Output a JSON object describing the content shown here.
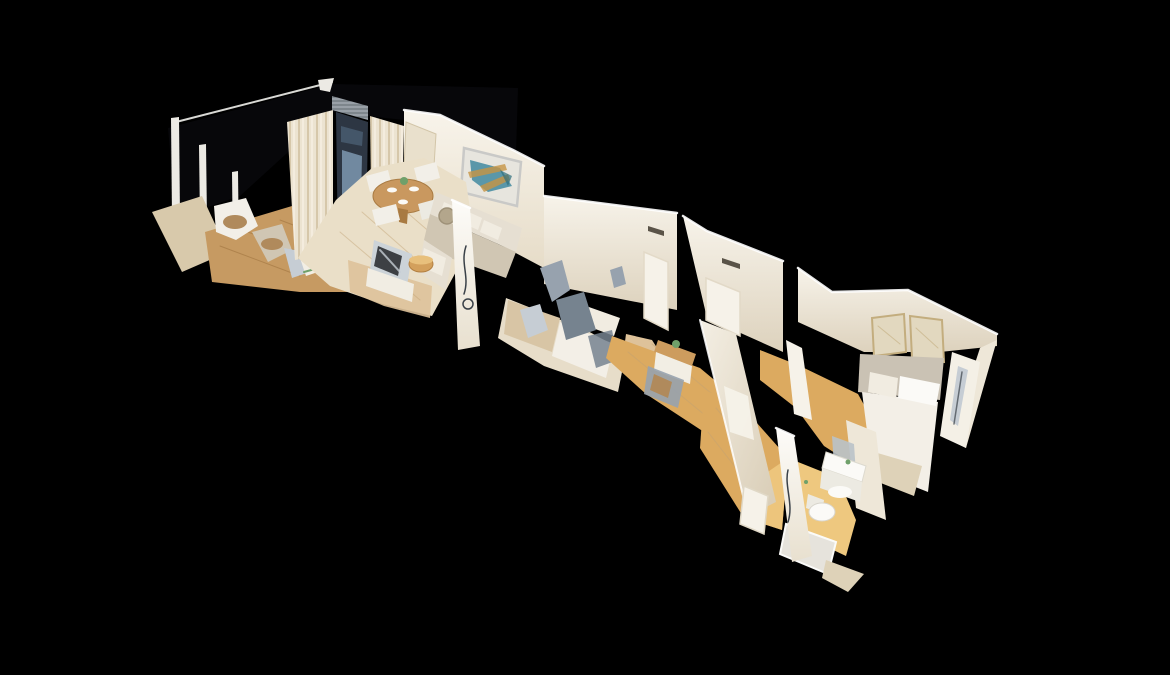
{
  "viewer": {
    "background": "#000000",
    "view": "dollhouse-3d-scan",
    "scene_description": "Aerial cutaway 3D scan of an elongated apartment laid diagonally: terrace, living-dining room, two bedrooms, office nook, hallway and bathrooms on black background"
  },
  "scene": {
    "rooms": [
      {
        "name": "terrace",
        "objects": [
          "dark-glass-panel",
          "white-frame-posts",
          "outdoor-chairs",
          "wood-deck",
          "sideboard"
        ]
      },
      {
        "name": "living-dining",
        "objects": [
          "curtains",
          "balcony-door",
          "venetian-blind",
          "abstract-painting",
          "wall-panel",
          "dining-table",
          "white-chairs",
          "corner-sofa",
          "tv",
          "wood-pouf"
        ]
      },
      {
        "name": "bedroom-1",
        "objects": [
          "unmade-bed",
          "mirror-artifacts",
          "shower-wall",
          "air-vent",
          "door"
        ]
      },
      {
        "name": "office",
        "objects": [
          "desk",
          "plant",
          "chair",
          "door"
        ]
      },
      {
        "name": "hallway",
        "objects": [
          "wood-floor",
          "long-wall",
          "open-door"
        ]
      },
      {
        "name": "bedroom-2",
        "objects": [
          "double-bed",
          "pillows",
          "headboard",
          "framed-artworks",
          "wardrobe"
        ]
      },
      {
        "name": "bathroom",
        "objects": [
          "mirror",
          "vanity-sink",
          "toilet",
          "shower-tray",
          "toiletries"
        ]
      }
    ]
  },
  "palette": {
    "bg": "#000000",
    "glass": "#07070a",
    "frameLine": "#d9d9d5",
    "post": "#eceae4",
    "tile": "#d8c9ab",
    "deck": "#c69a62",
    "deckLine": "#a0753f",
    "curtain": "#ece3d1",
    "curtainShadow": "#d6c7aa",
    "blind": "#99a0a7",
    "doorDark": "#2d3643",
    "paneBlue": "#7e98b0",
    "paneBlue2": "#5b7690",
    "wallWhite": "#f6f2e9",
    "wallCream": "#eee7d8",
    "wallShadow": "#ddd2bd",
    "cutWhite": "#ffffff",
    "panelBeige": "#e9e0cc",
    "panelEdge": "#d2c5a8",
    "artBg": "#e7e5de",
    "artTeal": "#4189a0",
    "artTeal2": "#2f6f7e",
    "artGold": "#c79544",
    "artFrame": "#c9c9c7",
    "floorCream": "#eadfc8",
    "floorWood": "#dec29a",
    "plankLine": "#c1a173",
    "hallWood": "#dcaa60",
    "hallWoodLight": "#eec87f",
    "chairWhite": "#f2efe8",
    "chairWood": "#b08a5c",
    "tableWood": "#c9985f",
    "tableEdge": "#a87a42",
    "sofa": "#e6dfd2",
    "sofaShade": "#d0c6b3",
    "pillow": "#f1ece1",
    "pillowTan": "#b3a68c",
    "tvSilver": "#ccd3d8",
    "tvDark": "#23262a",
    "standWhite": "#f1ede3",
    "poufWood": "#d3a05c",
    "poufTop": "#e8c07c",
    "bedLinen": "#e7ddc9",
    "blanket": "#d8c5a5",
    "bedWhite": "#f3efe7",
    "artifactGray": "#97a2ae",
    "artifactBlue": "#76838f",
    "artifactLight": "#c6cdd4",
    "artifactDark": "#3a4148",
    "deskWood": "#cd9c5e",
    "drawerWhite": "#f2eee4",
    "green": "#6fa06a",
    "headboard": "#cac2b4",
    "frameBeige": "#e2d8bf",
    "frameEdge": "#c3ad7e",
    "wardrobe": "#f4f0e6",
    "fixtureWhite": "#fbfaf7",
    "fixtureShade": "#eceae2",
    "tray": "#e6e3dc",
    "wedge": "#ded2b8",
    "mirror": "#b9c2c9",
    "vent": "#5a5348"
  }
}
